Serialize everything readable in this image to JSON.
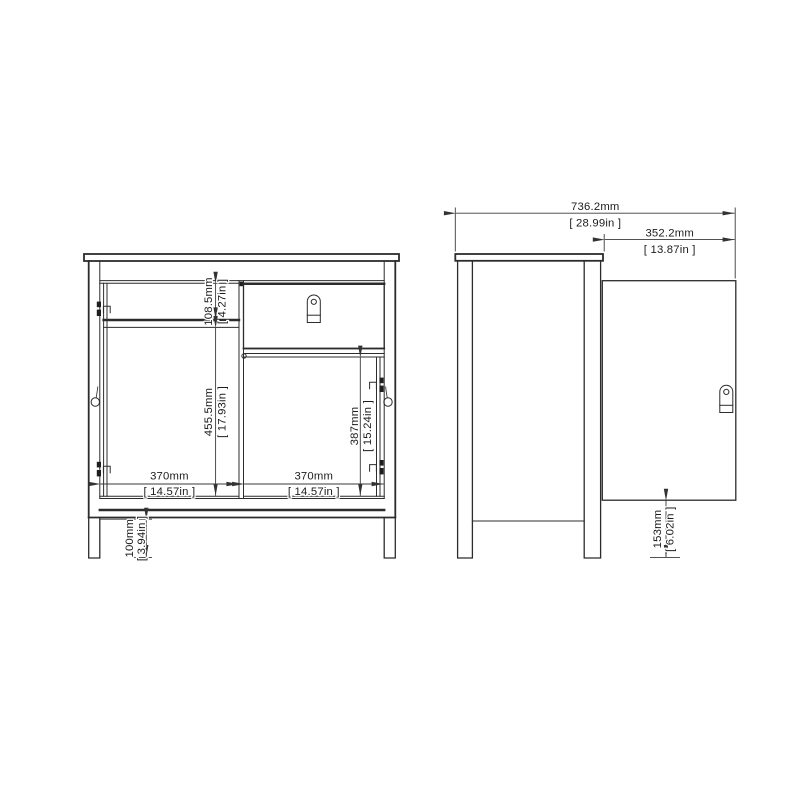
{
  "diagram": {
    "front_view": {
      "dimensions": {
        "top_section_height": {
          "mm": "108.5mm",
          "inches": "[ 4.27in ]"
        },
        "left_door_height": {
          "mm": "455.5mm",
          "inches": "[ 17.93in ]"
        },
        "right_door_height": {
          "mm": "387mm",
          "inches": "[ 15.24in ]"
        },
        "left_door_width": {
          "mm": "370mm",
          "inches": "[ 14.57in ]"
        },
        "right_door_width": {
          "mm": "370mm",
          "inches": "[ 14.57in ]"
        },
        "leg_height": {
          "mm": "100mm",
          "inches": "[ 3.94in ]"
        }
      }
    },
    "side_view": {
      "dimensions": {
        "depth_with_door_open": {
          "mm": "736.2mm",
          "inches": "[ 28.99in ]"
        },
        "door_open_projection": {
          "mm": "352.2mm",
          "inches": "[ 13.87in ]"
        },
        "door_bottom_clearance": {
          "mm": "153mm",
          "inches": "[ 6.02in ]"
        }
      }
    }
  }
}
